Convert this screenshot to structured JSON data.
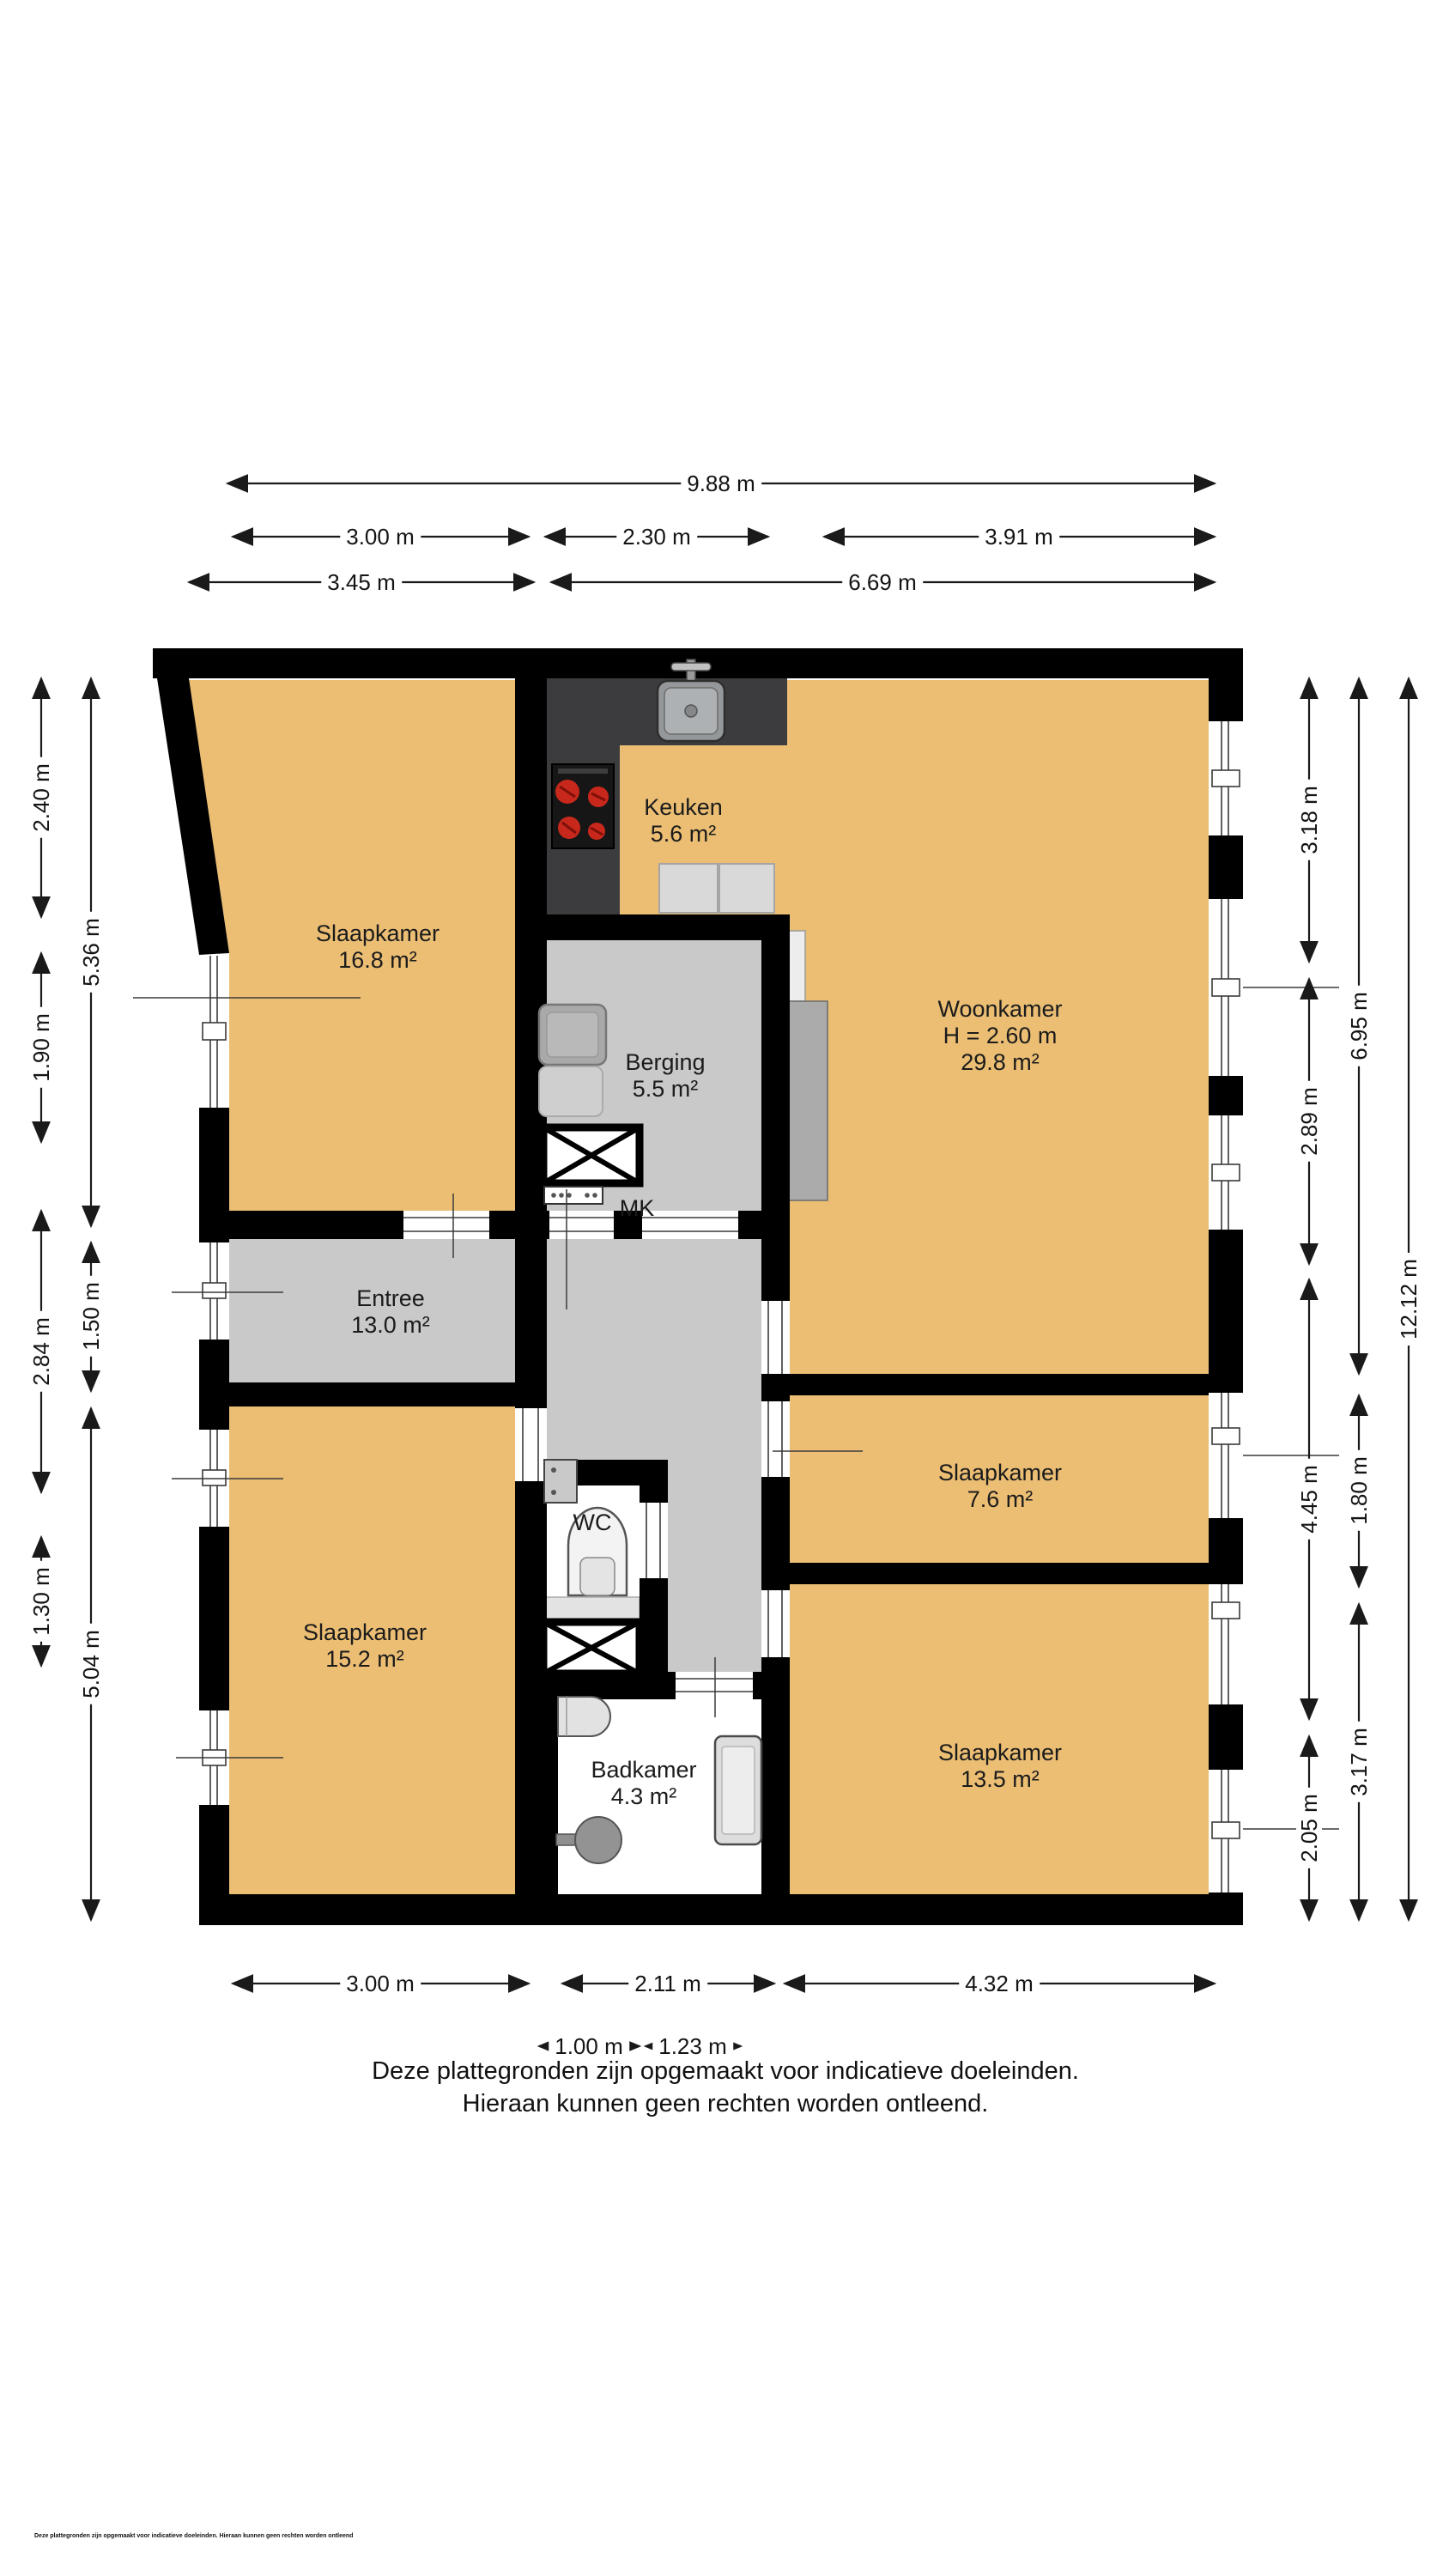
{
  "rooms": {
    "slaapkamer_nw": {
      "name": "Slaapkamer",
      "area": "16.8 m²"
    },
    "keuken": {
      "name": "Keuken",
      "area": "5.6 m²"
    },
    "woonkamer": {
      "name": "Woonkamer",
      "ceiling": "H = 2.60 m",
      "area": "29.8 m²"
    },
    "berging": {
      "name": "Berging",
      "area": "5.5 m²"
    },
    "entree": {
      "name": "Entree",
      "area": "13.0 m²"
    },
    "meterkast": {
      "name": "MK"
    },
    "wc": {
      "name": "WC"
    },
    "slaapkamer_e": {
      "name": "Slaapkamer",
      "area": "7.6 m²"
    },
    "slaapkamer_sw": {
      "name": "Slaapkamer",
      "area": "15.2 m²"
    },
    "slaapkamer_se": {
      "name": "Slaapkamer",
      "area": "13.5 m²"
    },
    "badkamer": {
      "name": "Badkamer",
      "area": "4.3 m²"
    }
  },
  "dims": {
    "top": [
      "9.88 m",
      "3.00 m",
      "2.30 m",
      "3.91 m",
      "3.45 m",
      "6.69 m"
    ],
    "bottom": [
      "3.00 m",
      "2.11 m",
      "4.32 m",
      "1.00 m",
      "1.23 m"
    ],
    "left_outer": [
      "2.40 m",
      "1.90 m",
      "2.84 m",
      "1.30 m"
    ],
    "left_inner": [
      "5.36 m",
      "1.50 m",
      "5.04 m"
    ],
    "right_inner": [
      "3.18 m",
      "2.89 m",
      "4.45 m",
      "2.05 m"
    ],
    "right_mid": [
      "6.95 m",
      "1.80 m",
      "3.17 m"
    ],
    "right_outer": [
      "12.12 m"
    ]
  },
  "footer": {
    "line1": "Deze plattegronden zijn opgemaakt voor indicatieve doeleinden.",
    "line2": "Hieraan kunnen geen rechten worden ontleend.",
    "micro": "Deze plattegronden zijn opgemaakt voor indicatieve doeleinden. Hieraan kunnen geen rechten worden ontleend"
  },
  "colors": {
    "room_floor": "#EBBE74",
    "hall_floor": "#C9C9C9",
    "wall": "#000000",
    "counter_dark": "#3C3C3E",
    "burner_red": "#C8281C",
    "column_gray": "#ABABAB"
  }
}
